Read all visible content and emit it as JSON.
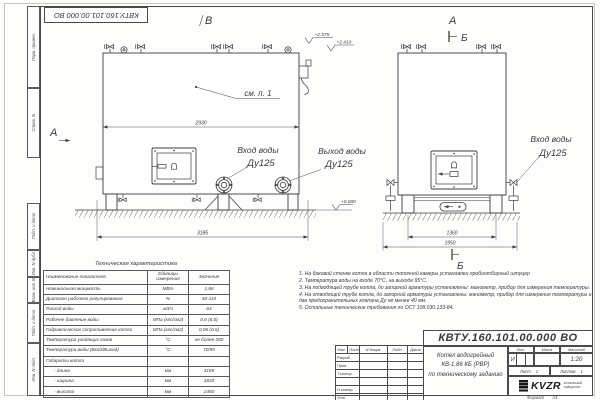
{
  "sheet": {
    "doc_number": "КВТУ.160.101.00.000 ВО",
    "format_label": "Формат",
    "format_value": "А3"
  },
  "margin_labels": [
    "Перв. примен.",
    "Справ. N",
    "Подп. и дата",
    "Инв. N дубл.",
    "Взам. инв. N",
    "Подп. и дата",
    "Инв. N подл."
  ],
  "views": {
    "front": {
      "letter_top": "В",
      "letter_left": "А",
      "callout": "см. п. 1",
      "dim_top": "2930",
      "dim_bottom": "3185",
      "inlet_label": "Вход воды",
      "inlet_size": "Ду125",
      "outlet_label": "Выход воды",
      "outlet_size": "Ду125",
      "elev_top_1": "+2.575",
      "elev_top_2": "+2.410",
      "elev_ground": "+0.000"
    },
    "side": {
      "letter_top": "А",
      "section_top": "Б",
      "section_bottom": "Б",
      "dim_inner": "1360",
      "dim_outer": "1950",
      "inlet_label": "Вход воды",
      "inlet_size": "Ду125"
    }
  },
  "spec_table": {
    "title": "Техническая характеристика",
    "headers": [
      "Наименование показателя",
      "Единицы измерения",
      "Значение"
    ],
    "rows": [
      {
        "name": "Номинальная мощность",
        "unit": "МВт",
        "value": "1,86"
      },
      {
        "name": "Диапазон рабочего регулирования",
        "unit": "%",
        "value": "40-110"
      },
      {
        "name": "Расход воды",
        "unit": "м3/ч",
        "value": "64"
      },
      {
        "name": "Рабочее давление воды",
        "unit": "МПа (кгс/см2)",
        "value": "0,6 (6,0)"
      },
      {
        "name": "Гидравлическое сопротивление котла",
        "unit": "МПа (кгс/см2)",
        "value": "0,06 (0,6)"
      },
      {
        "name": "Температура уходящих газов",
        "unit": "°С",
        "value": "не более 280"
      },
      {
        "name": "Температура воды (Вход/Выход)",
        "unit": "°С",
        "value": "70/95"
      },
      {
        "name": "Габариты котла",
        "unit": "",
        "value": ""
      },
      {
        "name": "- длина",
        "unit": "мм",
        "value": "3185"
      },
      {
        "name": "- ширина",
        "unit": "мм",
        "value": "1830"
      },
      {
        "name": "- высота",
        "unit": "мм",
        "value": "2460"
      }
    ]
  },
  "notes": [
    "1. На боковой стенке котла в области топочной камеры установлен пробоотборный штуцер",
    "2. Температура воды на входе 70°С, на выходе 95°С.",
    "3. На подводящей трубе котла, до запорной арматуры установлены: манометр, прибор для измерения температуры.",
    "4. На отводящей трубе котла, до запорной арматуры установлены: манометр, прибор для измерения температуры и два предохранительных клапана Ду не менее 40 мм.",
    "5. Остальные технические требования по ОСТ 108.030.133-84."
  ],
  "title_block": {
    "rev_headers": [
      "Изм.",
      "Лист",
      "N докум.",
      "Подп.",
      "Дата"
    ],
    "row_labels": [
      "Разраб.",
      "Пров.",
      "Т.контр.",
      "",
      "Н.контр.",
      "Утв."
    ],
    "title_line1": "Котел водогрейный",
    "title_line2": "КВ-1,86 КБ (РВР)",
    "title_line3": "по техническому заданию",
    "lit_label": "Лит.",
    "lit_value": "И",
    "mass_label": "Масса",
    "scale_label": "Масштаб",
    "scale_value": "1:20",
    "sheet_label": "Лист",
    "sheet_value": "1",
    "sheets_label": "Листов",
    "sheets_value": "1",
    "logo_text": "KVZR",
    "logo_sub1": "КОТЕЛЬНЫЙ",
    "logo_sub2": "ЗАВОД РЭП"
  },
  "colors": {
    "line": "#3d3d3d",
    "text": "#3a3a3a",
    "paper": "#fdfdfc"
  }
}
